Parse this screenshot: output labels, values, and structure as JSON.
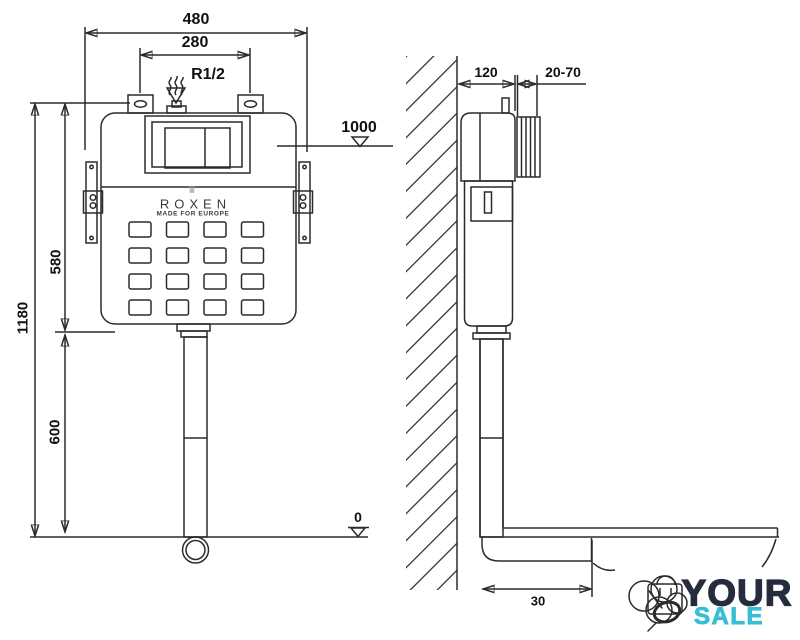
{
  "labels": {
    "total_width": "480",
    "inner_width": "280",
    "inlet_thread": "R1/2",
    "level_1000": "1000",
    "upper_height": "580",
    "total_height": "1180",
    "lower_height": "600",
    "level_zero": "0",
    "depth": "120",
    "adjust_range": "20-70",
    "outlet_offset": "30"
  },
  "brand": {
    "crown_icon": "♛",
    "name": "ROXEN",
    "tagline": "MADE FOR EUROPE"
  },
  "watermark": {
    "word_top": "YOUR",
    "word_bottom": "SALE"
  },
  "colors": {
    "line": "#2b2b2b",
    "bracket_gray": "#9c9c9c",
    "logo_teal": "#3cc3d6",
    "logo_navy": "#242c3e"
  }
}
